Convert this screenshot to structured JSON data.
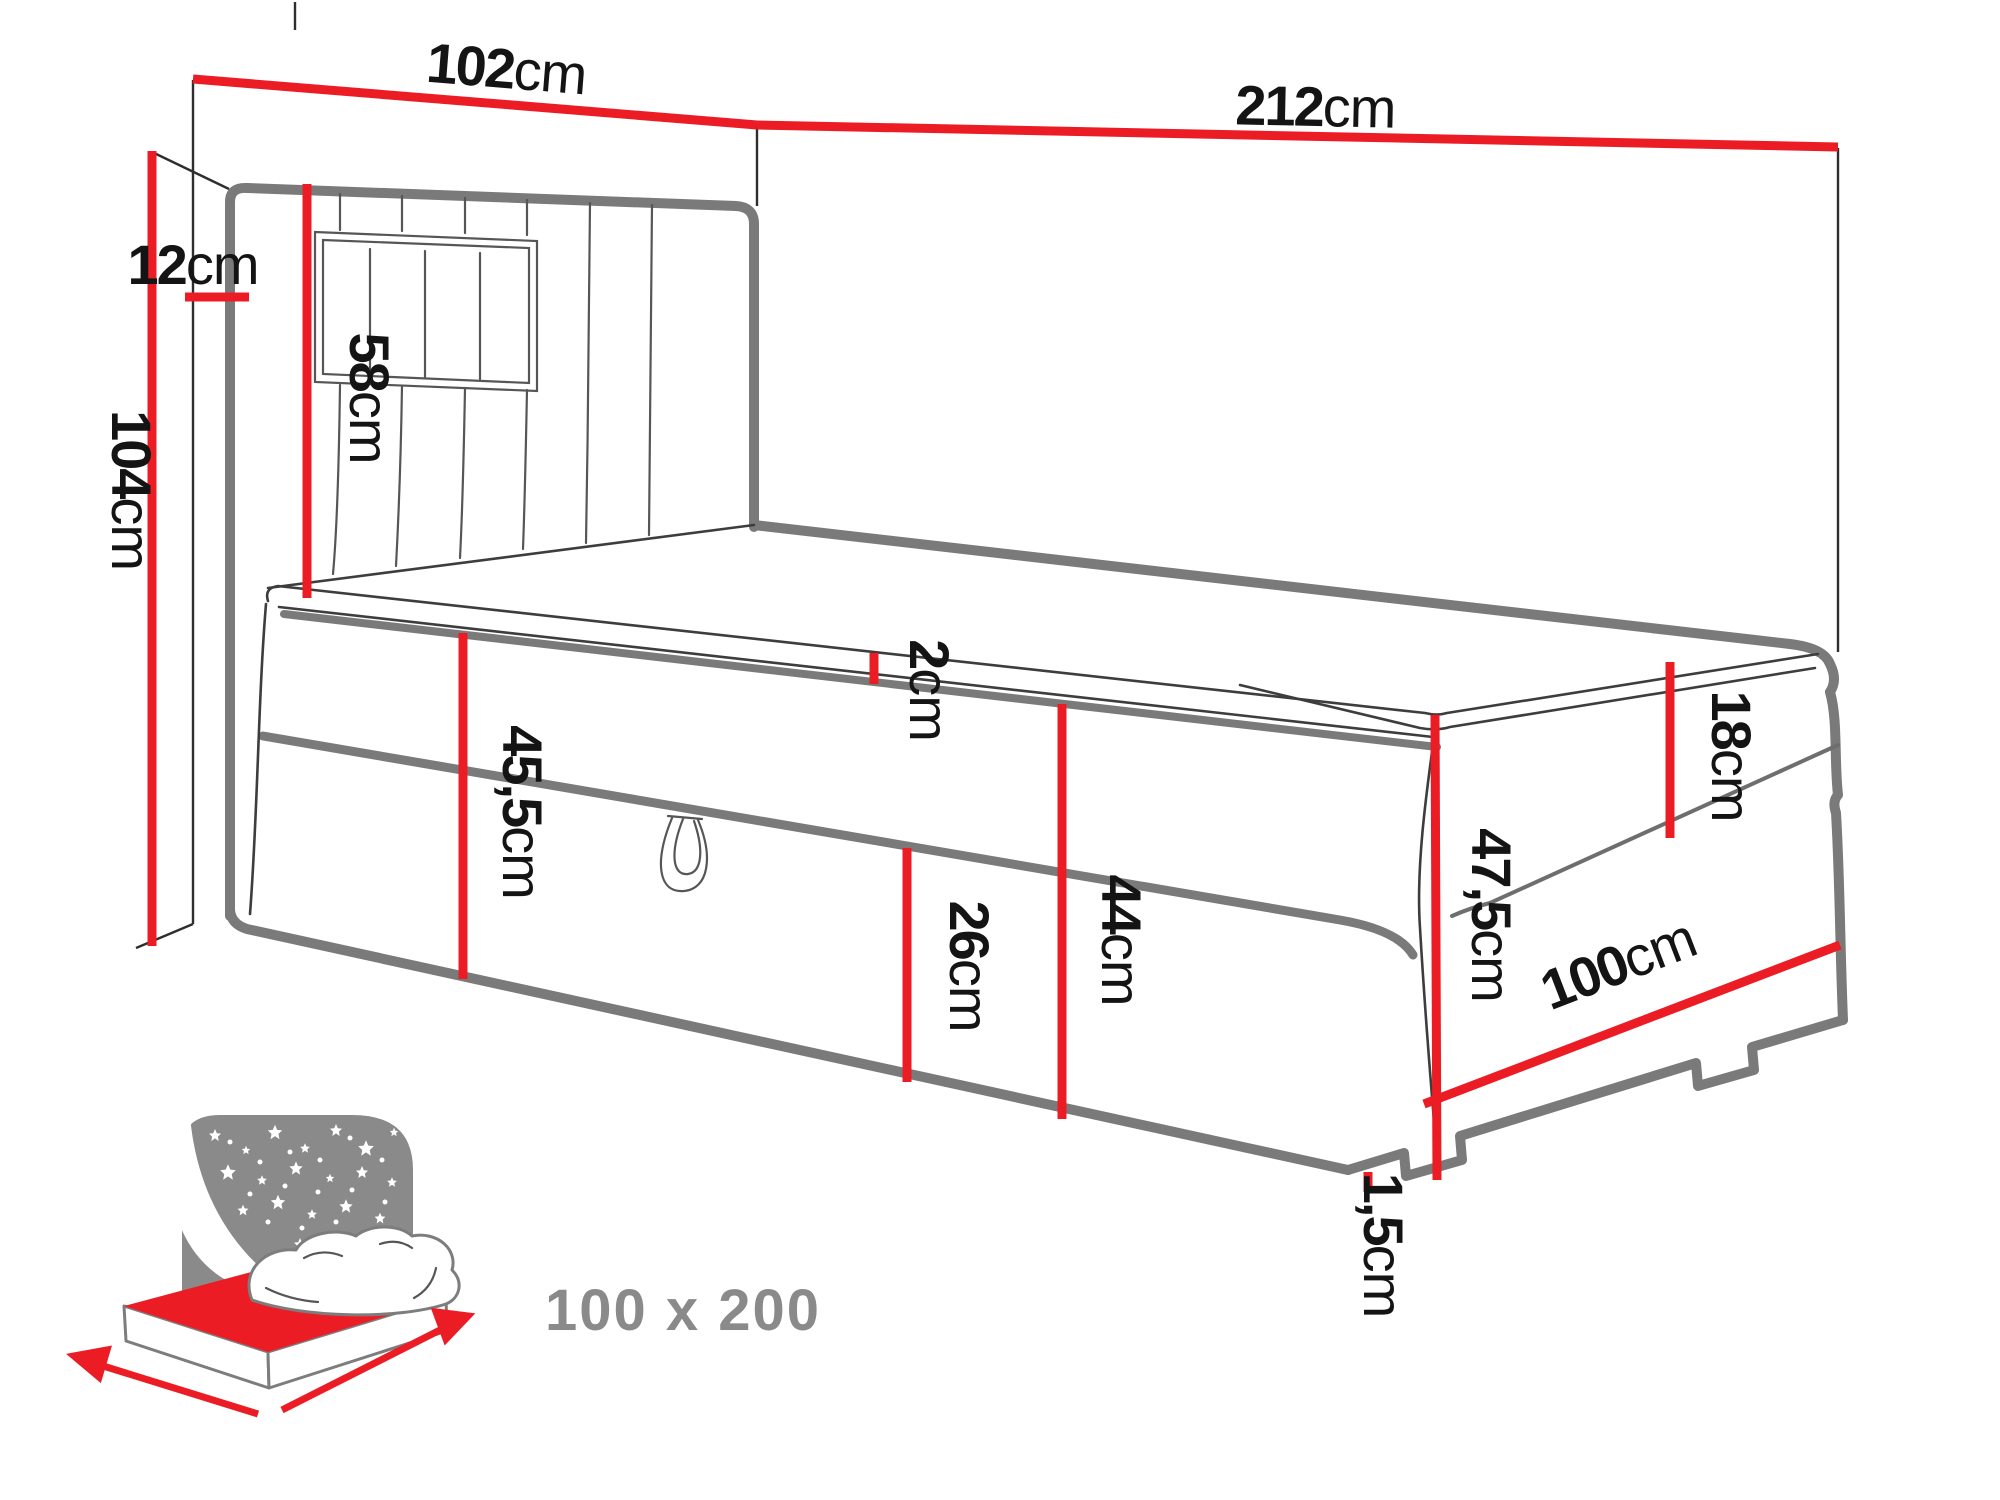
{
  "diagram": {
    "type": "furniture-dimension-diagram",
    "subject": "single boxspring bed with upholstered headboard and storage drawer, shown against wall corner",
    "unit": "cm",
    "dimensions": [
      {
        "name": "headboard-width",
        "value": "102",
        "unit": "cm"
      },
      {
        "name": "bed-total-length",
        "value": "212",
        "unit": "cm"
      },
      {
        "name": "wall-to-headboard-depth",
        "value": "12",
        "unit": "cm"
      },
      {
        "name": "headboard-total-height",
        "value": "104",
        "unit": "cm"
      },
      {
        "name": "headboard-above-mattress-height",
        "value": "58",
        "unit": "cm"
      },
      {
        "name": "topper-thickness",
        "value": "2",
        "unit": "cm"
      },
      {
        "name": "side-base-height",
        "value": "45,5",
        "unit": "cm"
      },
      {
        "name": "drawer-front-height",
        "value": "26",
        "unit": "cm"
      },
      {
        "name": "base-height-at-foot",
        "value": "44",
        "unit": "cm"
      },
      {
        "name": "mattress-thickness",
        "value": "18",
        "unit": "cm"
      },
      {
        "name": "foot-end-base-height",
        "value": "47,5",
        "unit": "cm"
      },
      {
        "name": "bed-width",
        "value": "100",
        "unit": "cm"
      },
      {
        "name": "leg-height",
        "value": "1,5",
        "unit": "cm"
      }
    ],
    "icon_caption": "100 x 200",
    "colors": {
      "dimension_line": "#ec1c24",
      "outline_thick": "#7a7a7a",
      "outline_thin": "#3d3d3d",
      "icon_gray": "#8a8a8a",
      "label_text": "#141414",
      "caption_text": "#8a8a8a",
      "background": "#ffffff"
    }
  }
}
